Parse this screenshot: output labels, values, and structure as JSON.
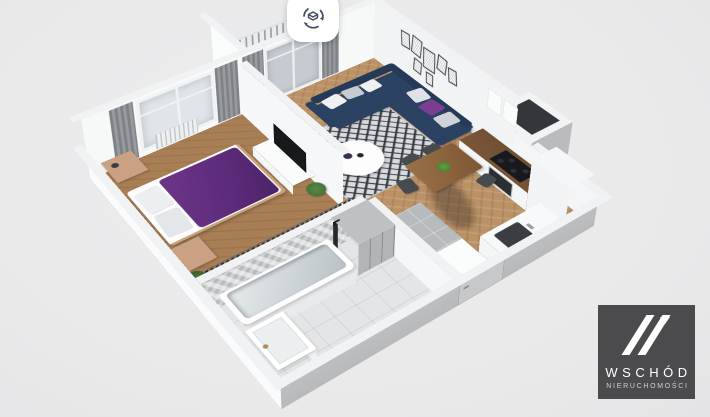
{
  "view": {
    "background": "#e9e9ea",
    "kind": "3d-apartment-floorplan-render"
  },
  "toolbar": {
    "rotate_button": {
      "icon": "rotate-3d-view",
      "shape": "rounded-square-white"
    }
  },
  "logo": {
    "brand": "WSCHÓD",
    "tagline": "NIERUCHOMOŚCI"
  },
  "theme": {
    "bg": "#e9e9ea",
    "wall_white": "#f7f8f8",
    "wall_cap": "#f1f2f3",
    "wall_shade": "#b7b9bb",
    "wood_bed": "#a87e55",
    "wood_living": "#bb9266",
    "tile_gray": "#b8bbbd",
    "bath_floor": "#e3e5e6",
    "sofa_navy": "#2c4263",
    "sofa_dark": "#243a58",
    "bed_purple": "#5e2c7c",
    "curtain": "#85898e",
    "rug_light": "#d9dbdf",
    "rug_dark": "#34383e",
    "counter_wood": "#6e4e33",
    "logo_bg": "#4b4b4d",
    "icon_navy": "#3f4e63",
    "clothes": "#262b33",
    "cab_gray": "#b2b5b8"
  },
  "scene": {
    "type": "3d-floorplan",
    "camera": "high-angle isometric, rotated ~35deg",
    "rooms": [
      {
        "name": "bedroom",
        "floor": "wood",
        "furniture": [
          "double-bed-purple-duvet",
          "white-pillows",
          "wood-dresser",
          "nightstand",
          "plant",
          "gray-curtains",
          "tall-window",
          "radiator",
          "tv-cabinet",
          "tv"
        ]
      },
      {
        "name": "wardrobe-corridor",
        "furniture": [
          "open-closet-hanging-clothes",
          "gray-cabinet"
        ]
      },
      {
        "name": "living-room",
        "floor": "wood-herringbone",
        "furniture": [
          "navy-corner-sofa",
          "throw-pillows",
          "purple-pillow",
          "round-white-coffee-table",
          "diamond-pattern-rug",
          "gallery-wall-frames",
          "gray-curtains",
          "balcony-door",
          "person-shadow-on-floor"
        ]
      },
      {
        "name": "kitchen",
        "furniture": [
          "l-shaped-counter",
          "black-cooktop",
          "oven",
          "upper-cabinets",
          "tall-cabinet",
          "sink",
          "dining-table",
          "dark-chairs",
          "green-centerpiece"
        ]
      },
      {
        "name": "bathroom",
        "floor": "light-tile",
        "furniture": [
          "bathtub",
          "black-shower-column",
          "vanity-sink-brass-faucet",
          "washing-machine",
          "herringbone-tiled-wall",
          "gray-cabinet"
        ]
      },
      {
        "name": "hallway",
        "floor": "gray-tiles",
        "furniture": [
          "entrance-door"
        ]
      },
      {
        "name": "balcony",
        "furniture": [
          "railing",
          "wood-bistro-table",
          "two-chairs"
        ]
      },
      {
        "name": "utility-shaft",
        "furniture": []
      }
    ]
  }
}
